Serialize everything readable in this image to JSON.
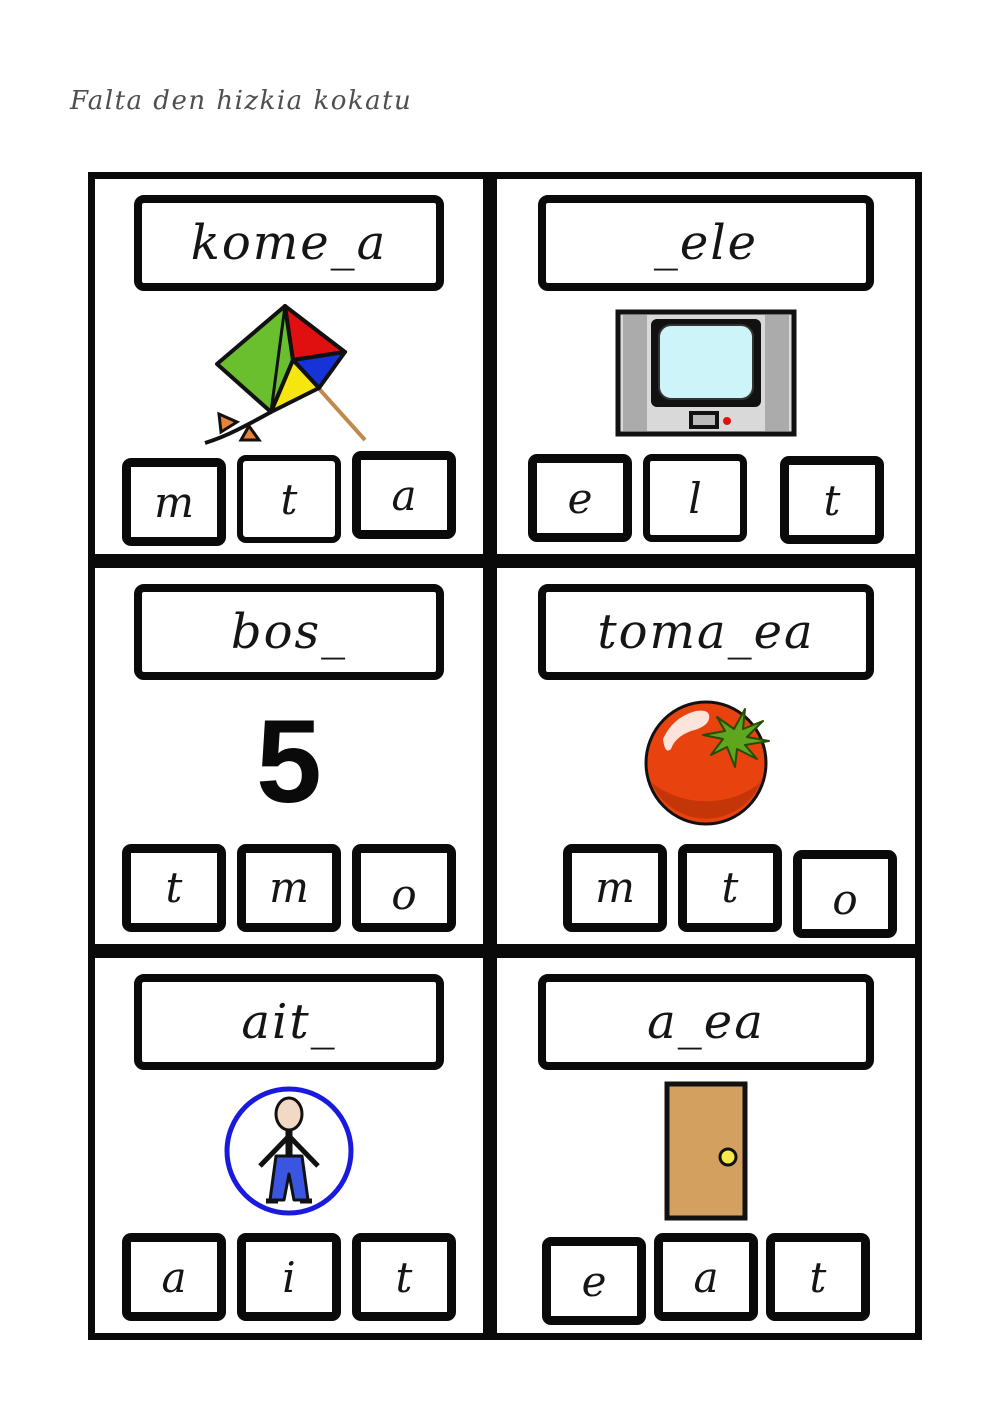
{
  "page": {
    "title": "Falta den hizkia kokatu"
  },
  "colors": {
    "ink": "#0a0a0a",
    "title_gray": "#4f4f4f",
    "kite_green": "#6abf2e",
    "kite_red": "#e01010",
    "kite_blue": "#1533d6",
    "kite_yellow": "#f5e511",
    "kite_string_brown": "#c08a4e",
    "kite_bow_orange": "#e8833a",
    "tv_body_gray": "#d9d9d9",
    "tv_side_gray": "#ababab",
    "tv_screen_cyan": "#cdf4f8",
    "tv_dot_red": "#e01010",
    "tomato_red": "#e8430f",
    "tomato_shadow": "#c43508",
    "tomato_leaf_green": "#5fa51e",
    "person_circle_blue": "#1a1adf",
    "person_skin": "#f2d9c5",
    "person_pants_blue": "#3a55e0",
    "door_tan": "#d3a05f",
    "door_knob_yellow": "#f7e948"
  },
  "cards": [
    {
      "word": "kome_a",
      "image": "kite",
      "letters": [
        "m",
        "t",
        "a"
      ]
    },
    {
      "word": "_ele",
      "image": "television",
      "letters": [
        "e",
        "l",
        "t"
      ]
    },
    {
      "word": "bos_",
      "image": "number-five",
      "figure_text": "5",
      "letters": [
        "t",
        "m",
        "o"
      ]
    },
    {
      "word": "toma_ea",
      "image": "tomato",
      "letters": [
        "m",
        "t",
        "o"
      ]
    },
    {
      "word": "ait_",
      "image": "person",
      "letters": [
        "a",
        "i",
        "t"
      ]
    },
    {
      "word": "a_ea",
      "image": "door",
      "letters": [
        "e",
        "a",
        "t"
      ]
    }
  ]
}
